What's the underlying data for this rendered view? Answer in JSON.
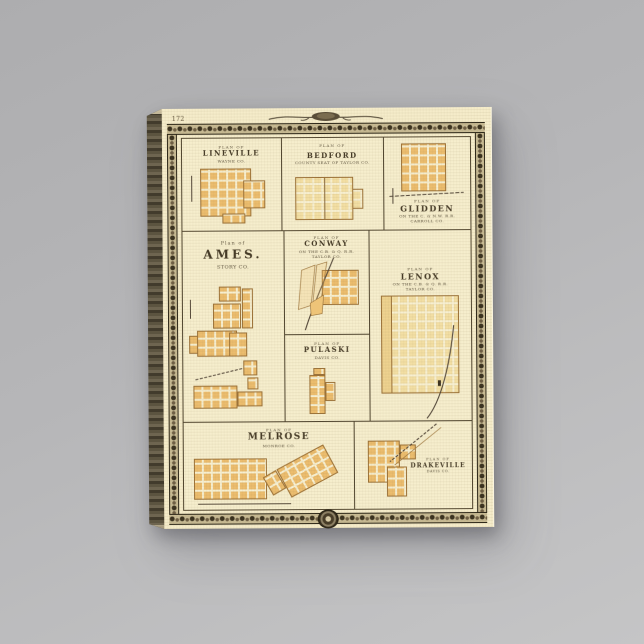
{
  "artwork": {
    "page_number": "172",
    "panels": {
      "lineville": {
        "plan_label": "PLAN OF",
        "name": "LINEVILLE",
        "sub1": "WAYNE CO."
      },
      "bedford": {
        "plan_label": "PLAN OF",
        "name": "BEDFORD",
        "sub1": "COUNTY SEAT OF TAYLOR CO."
      },
      "glidden": {
        "plan_label": "PLAN OF",
        "name": "GLIDDEN",
        "sub1": "ON THE C. & N.W. R.R.",
        "sub2": "CARROLL CO."
      },
      "ames": {
        "plan_label": "Plan of",
        "name": "AMES.",
        "sub1": "STORY CO."
      },
      "conway": {
        "plan_label": "PLAN OF",
        "name": "CONWAY",
        "sub1": "ON THE C.B. & Q. R.R.",
        "sub2": "TAYLOR CO."
      },
      "lenox": {
        "plan_label": "PLAN OF",
        "name": "LENOX",
        "sub1": "ON THE C.B. & Q. R.R.",
        "sub2": "TAYLOR CO."
      },
      "pulaski": {
        "plan_label": "PLAN OF",
        "name": "PULASKI",
        "sub1": "DAVIS CO."
      },
      "melrose": {
        "plan_label": "PLAN OF",
        "name": "MELROSE",
        "sub1": "MONROE CO."
      },
      "drakeville": {
        "plan_label": "PLAN OF",
        "name": "DRAKEVILLE",
        "sub1": "DAVIS CO."
      }
    },
    "colors": {
      "wall": "#b4b4b6",
      "paper": "#f5ecca",
      "block_orange": "#ecbd6e",
      "block_pale": "#f3dfa4",
      "ornament_dark": "#39311f",
      "rule": "#50452f",
      "ink": "#453a26"
    }
  }
}
